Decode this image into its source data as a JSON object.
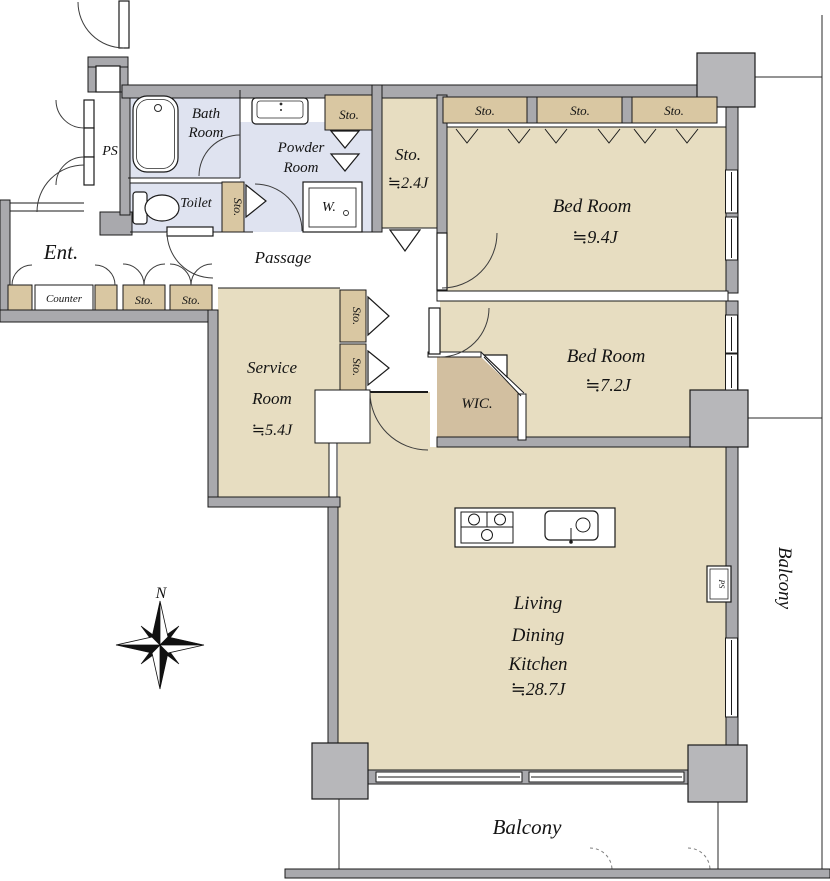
{
  "colors": {
    "room": "#e7ddc1",
    "closet": "#d9c7a2",
    "wic": "#d2bfa0",
    "wet": "#dfe3f0",
    "wall": "#a9a9ad",
    "pillar": "#b7b7ba",
    "line": "#1a1a1a"
  },
  "labels": {
    "ent": "Ent.",
    "counter": "Counter",
    "passage": "Passage",
    "ps": "PS",
    "ps_small": "PS",
    "toilet": "Toilet",
    "washer": "W.",
    "sto": "Sto.",
    "wic": "WIC.",
    "north": "N",
    "bath": {
      "l1": "Bath",
      "l2": "Room"
    },
    "powder": {
      "l1": "Powder",
      "l2": "Room"
    },
    "storage24": {
      "l1": "Sto.",
      "l2": "≒2.4J"
    },
    "bedroom94": {
      "l1": "Bed Room",
      "l2": "≒9.4J"
    },
    "bedroom72": {
      "l1": "Bed Room",
      "l2": "≒7.2J"
    },
    "service": {
      "l1": "Service",
      "l2": "Room",
      "l3": "≒5.4J"
    },
    "ldk": {
      "l1": "Living",
      "l2": "Dining",
      "l3": "Kitchen",
      "l4": "≒28.7J"
    },
    "balcony_right": "Balcony",
    "balcony_bottom": "Balcony"
  }
}
